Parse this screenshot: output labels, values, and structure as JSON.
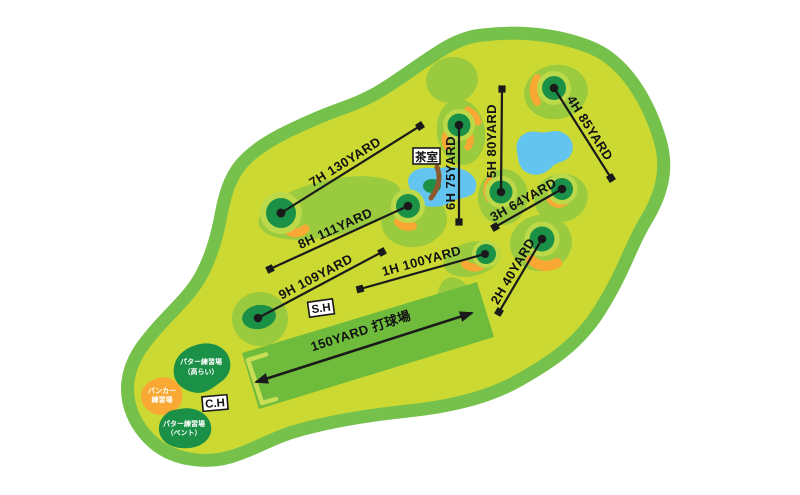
{
  "holes": [
    {
      "label": "1H 100YARD"
    },
    {
      "label": "2H 40YARD"
    },
    {
      "label": "3H 64YARD"
    },
    {
      "label": "4H 85YARD"
    },
    {
      "label": "5H 80YARD"
    },
    {
      "label": "6H 75YARD"
    },
    {
      "label": "7H 130YARD"
    },
    {
      "label": "8H 111YARD"
    },
    {
      "label": "9H 109YARD"
    }
  ],
  "driving_range": {
    "label": "150YARD 打球場"
  },
  "facilities": {
    "tea_room_label": "茶室",
    "start_house_label": "S.H",
    "club_house_label": "C.H",
    "bunker_practice": {
      "line1": "バンカー",
      "line2": "練習場"
    },
    "putter_practice_korai": {
      "line1": "パター練習場",
      "line2": "（高らい）"
    },
    "putter_practice_bent": {
      "line1": "パター練習場",
      "line2": "（ベント）"
    }
  },
  "colors": {
    "background": "#ffffff",
    "course_border": "#76c14b",
    "course_fill": "#cbd932",
    "fairway_mound": "#9aca3e",
    "green_fringe": "#bcd94a",
    "putting_green": "#1a9147",
    "bunker_sand": "#f9a933",
    "water": "#63c4ef",
    "bridge": "#8a5a2e",
    "driving_range": "#6fbc3d",
    "line": "#1a1a1a"
  }
}
